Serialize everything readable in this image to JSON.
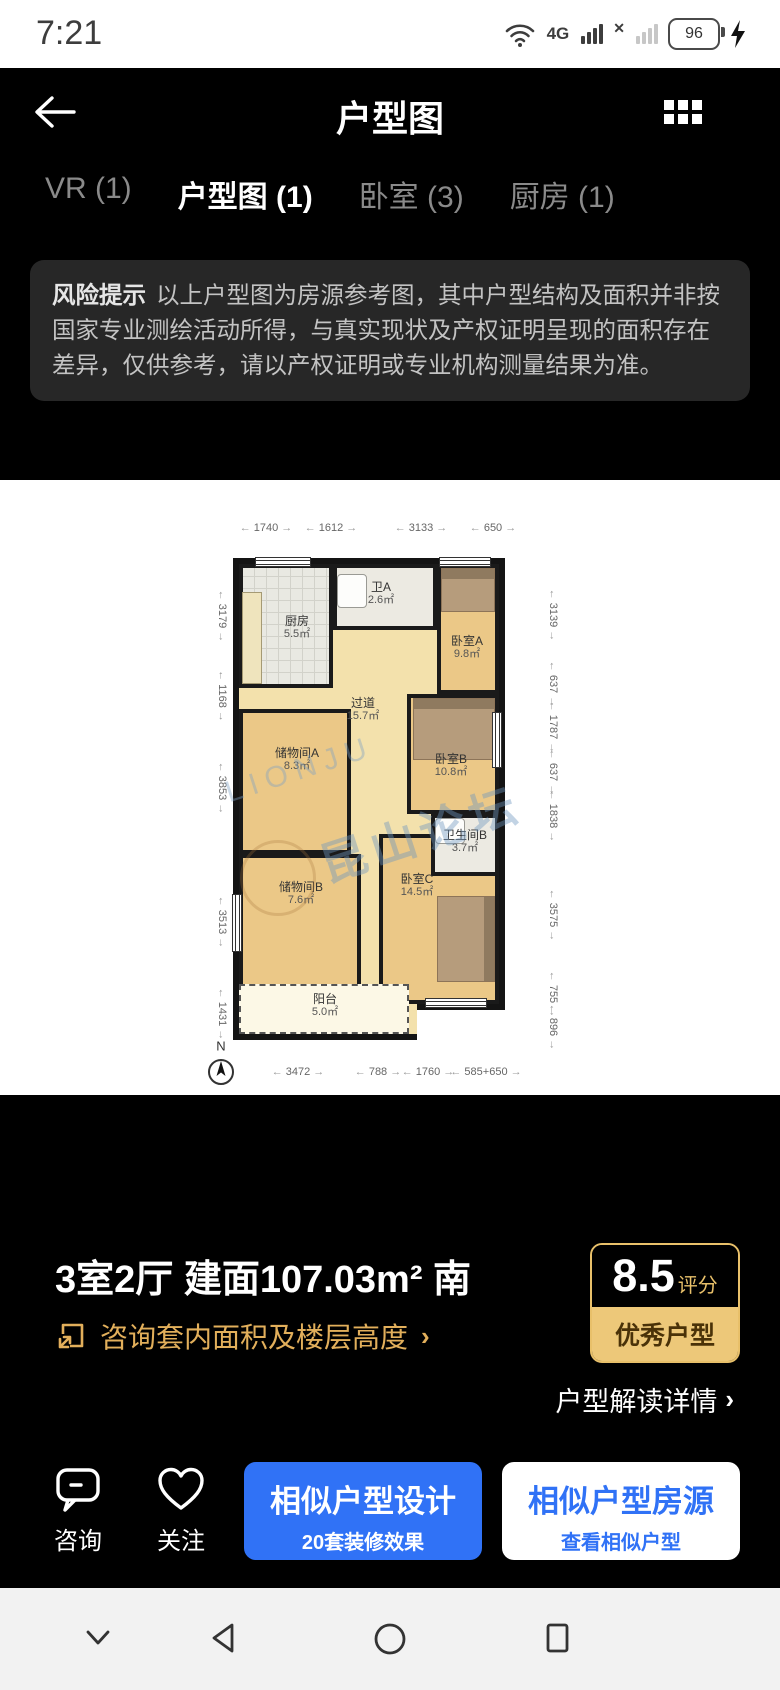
{
  "status_bar": {
    "time": "7:21",
    "battery_level": "96",
    "network_4g": "4G",
    "sim2_no_signal": "✕"
  },
  "header": {
    "title": "户型图"
  },
  "tabs": [
    {
      "label": "VR (1)"
    },
    {
      "label": "户型图 (1)"
    },
    {
      "label": "卧室 (3)"
    },
    {
      "label": "厨房 (1)"
    }
  ],
  "risk_notice": {
    "label": "风险提示",
    "text": "以上户型图为房源参考图，其中户型结构及面积并非按国家专业测绘活动所得，与真实现状及产权证明呈现的面积存在差异，仅供参考，请以产权证明或专业机构测量结果为准。"
  },
  "floor_plan": {
    "watermark_latin": "LIONJU",
    "watermark_cn": "昆山论坛",
    "compass_label": "N",
    "rooms": [
      {
        "name": "厨房",
        "area": "5.5㎡"
      },
      {
        "name": "卫A",
        "area": "2.6㎡"
      },
      {
        "name": "卧室A",
        "area": "9.8㎡"
      },
      {
        "name": "过道",
        "area": "15.7㎡"
      },
      {
        "name": "储物间A",
        "area": "8.3㎡"
      },
      {
        "name": "卧室B",
        "area": "10.8㎡"
      },
      {
        "name": "卫生间B",
        "area": "3.7㎡"
      },
      {
        "name": "储物间B",
        "area": "7.6㎡"
      },
      {
        "name": "卧室C",
        "area": "14.5㎡"
      },
      {
        "name": "阳台",
        "area": "5.0㎡"
      }
    ],
    "dims_top": [
      "1740",
      "1612",
      "3133",
      "650"
    ],
    "dims_left": [
      "3179",
      "1168",
      "3853",
      "3513",
      "1431"
    ],
    "dims_right": [
      "3139",
      "637",
      "1787",
      "637",
      "1838",
      "3575",
      "755",
      "896"
    ],
    "dims_bottom": [
      "3472",
      "788",
      "1760",
      "585+650"
    ]
  },
  "summary": {
    "title": "3室2厅 建面107.03m² 南",
    "consult_link": "咨询套内面积及楼层高度",
    "chevron": "›",
    "score_value": "8.5",
    "score_unit": "评分",
    "score_tag": "优秀户型",
    "detail_link": "户型解读详情"
  },
  "action_bar": {
    "consult_label": "咨询",
    "follow_label": "关注",
    "primary": {
      "title": "相似户型设计",
      "subtitle": "20套装修效果"
    },
    "secondary": {
      "title": "相似户型房源",
      "subtitle": "查看相似户型"
    }
  },
  "colors": {
    "accent_blue": "#3072F6",
    "gold": "#E8C06A",
    "tag_bg": "#EDC879",
    "wall": "#1A1A1A",
    "floor": "#EBC887"
  }
}
